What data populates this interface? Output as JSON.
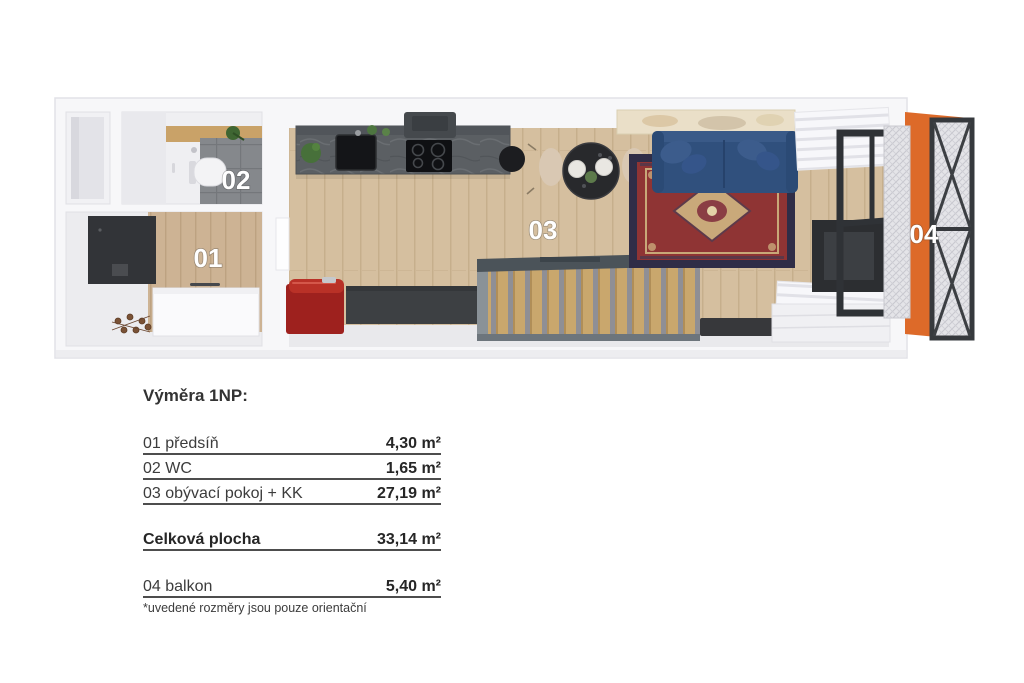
{
  "floor_plan": {
    "description": "Top-down 3D render of studio apartment 1NP",
    "rooms": [
      {
        "id": "room-01",
        "label": "01",
        "name": "předsíň"
      },
      {
        "id": "room-02",
        "label": "02",
        "name": "WC"
      },
      {
        "id": "room-03",
        "label": "03",
        "name": "obývací pokoj + KK"
      },
      {
        "id": "room-04",
        "label": "04",
        "name": "balkon"
      }
    ]
  },
  "legend": {
    "title": "Výměra 1NP:",
    "rows": [
      {
        "label": "01 předsíň",
        "value": "4,30 m²"
      },
      {
        "label": "02 WC",
        "value": "1,65 m²"
      },
      {
        "label": "03 obývací pokoj + KK",
        "value": "27,19 m²"
      }
    ],
    "total": {
      "label": "Celková plocha",
      "value": "33,14 m²"
    },
    "extra": {
      "label": "04 balkon",
      "value": "5,40 m²"
    },
    "footnote": "*uvedené rozměry jsou pouze orientační"
  },
  "colors": {
    "wood_floor": "#d5bf9f",
    "hall_wood": "#cdb394",
    "kitchen_counter": "#5b5f63",
    "sofa_blue": "#30507d",
    "rug_red": "#8f3434",
    "rug_border_navy": "#2f2d47",
    "balcony_orange": "#dd6a29",
    "red_cabinet": "#9e211e",
    "dark_bench": "#3d4043",
    "tile_gray": "#85888c",
    "stair_wood": "#c9a76d",
    "text_dark": "#3c3c3c"
  }
}
